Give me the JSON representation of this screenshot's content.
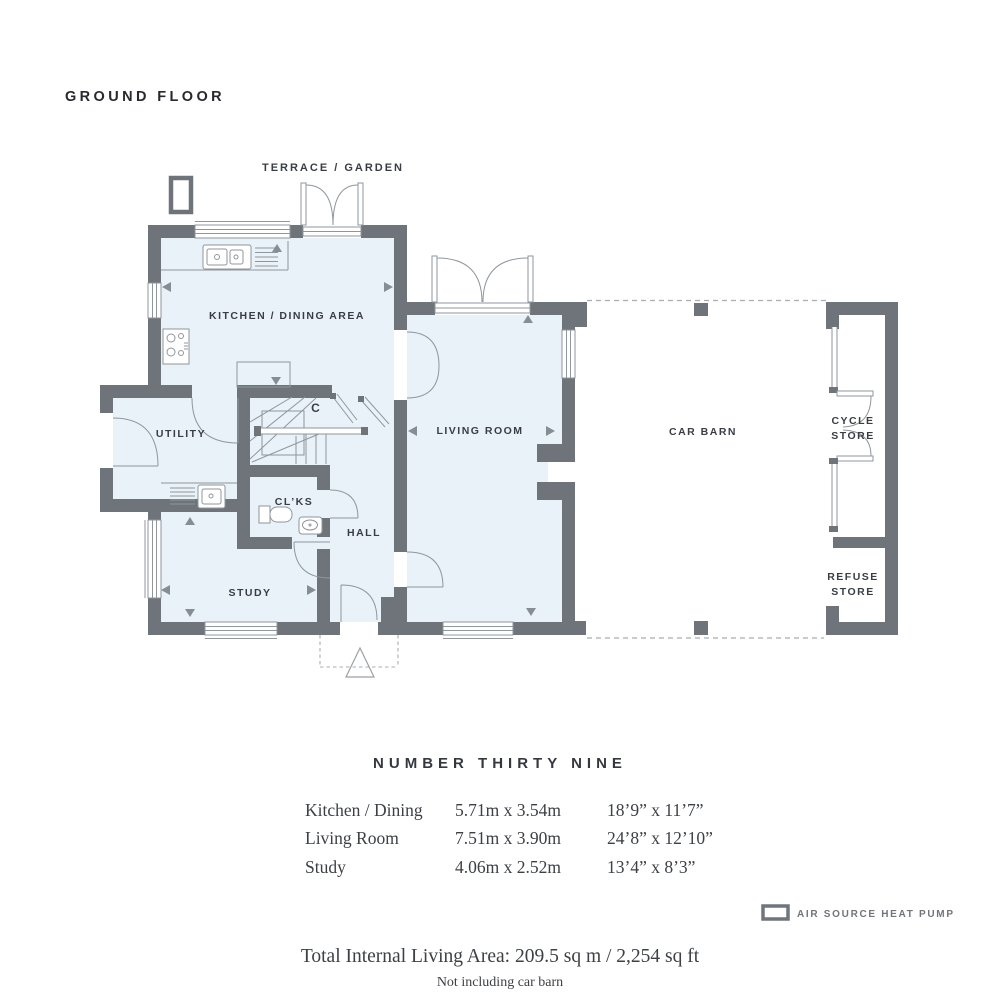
{
  "title": "GROUND FLOOR",
  "plan": {
    "terrace_label": "TERRACE / GARDEN",
    "rooms": {
      "kitchen": "KITCHEN / DINING AREA",
      "utility": "UTILITY",
      "cupboard": "C",
      "cloakroom": "CL’KS",
      "hall": "HALL",
      "study": "STUDY",
      "living_room": "LIVING ROOM",
      "car_barn": "CAR BARN",
      "cycle_store_line1": "CYCLE",
      "cycle_store_line2": "STORE",
      "refuse_store_line1": "REFUSE",
      "refuse_store_line2": "STORE"
    },
    "colors": {
      "wall": "#6e747a",
      "floor": "#e9f2f9",
      "line": "#8f969c",
      "dashed": "#a8adb2"
    }
  },
  "details": {
    "heading": "NUMBER THIRTY NINE",
    "rows": [
      {
        "room": "Kitchen / Dining",
        "metric": "5.71m x 3.54m",
        "imperial": "18’9” x 11’7”"
      },
      {
        "room": "Living Room",
        "metric": "7.51m x 3.90m",
        "imperial": "24’8” x 12’10”"
      },
      {
        "room": "Study",
        "metric": "4.06m x 2.52m",
        "imperial": "13’4” x 8’3”"
      }
    ]
  },
  "legend": {
    "label": "AIR SOURCE HEAT PUMP"
  },
  "totals": {
    "area": "Total Internal Living Area: 209.5 sq m / 2,254 sq ft",
    "note": "Not including car barn"
  }
}
